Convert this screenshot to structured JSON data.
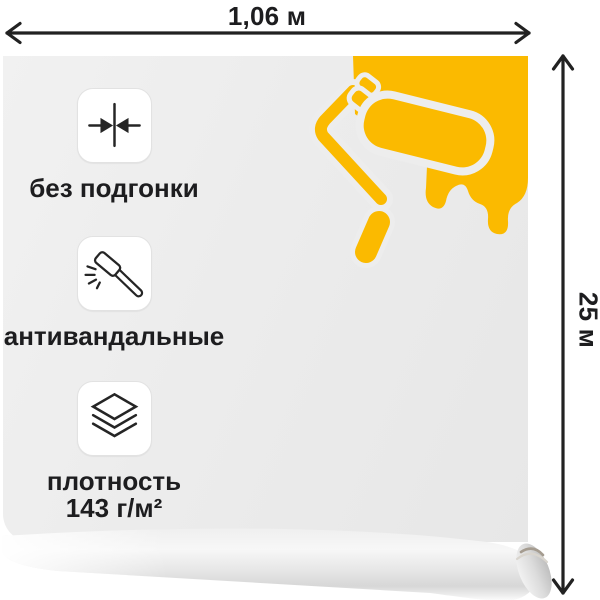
{
  "product": {
    "kind": "wallpaper-roll-product-image"
  },
  "dimensions": {
    "width_label": "1,06 м",
    "height_label": "25 м"
  },
  "features": [
    {
      "icon": "converging-arrows-icon",
      "label": "без подгонки"
    },
    {
      "icon": "hammer-icon",
      "label": "антивандальные"
    },
    {
      "icon": "layers-icon",
      "label": "плотность",
      "label2": "143 г/м²"
    }
  ],
  "colors": {
    "accent_yellow": "#FBBA00",
    "sheet_gray": "#EDEDED",
    "text": "#1D1D1F",
    "arrow": "#222222",
    "icon_stroke": "#252525"
  }
}
